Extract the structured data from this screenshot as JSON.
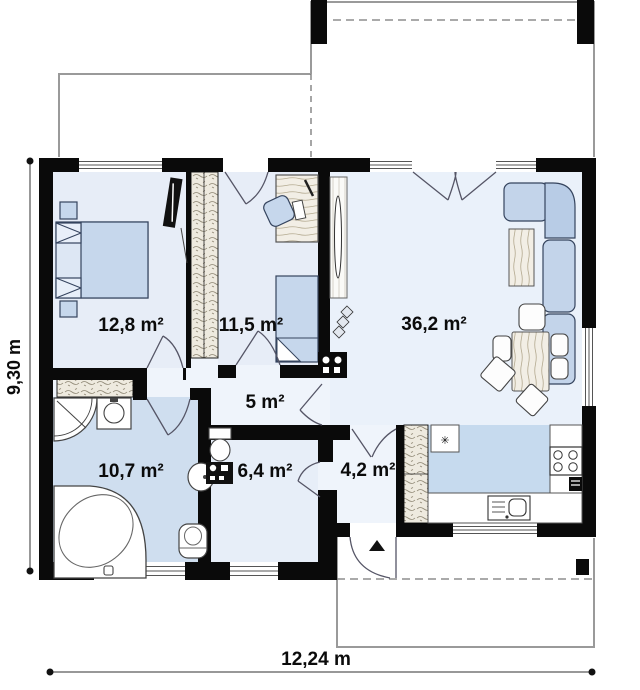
{
  "plan": {
    "rooms": [
      {
        "name": "bedroom-1",
        "area_label": "12,8 m²"
      },
      {
        "name": "bedroom-2",
        "area_label": "11,5 m²"
      },
      {
        "name": "living-room",
        "area_label": "36,2 m²"
      },
      {
        "name": "hall",
        "area_label": "5 m²"
      },
      {
        "name": "bathroom",
        "area_label": "10,7 m²"
      },
      {
        "name": "wc",
        "area_label": "6,4 m²"
      },
      {
        "name": "vestibule",
        "area_label": "4,2 m²"
      }
    ],
    "dimensions": {
      "total_width": "12,24 m",
      "total_height": "9,30 m"
    },
    "colors": {
      "wall": "#0a0a0a",
      "floor_light": "#e7edf7",
      "floor_bath": "#cfdeef",
      "floor_kitchen": "#c6daee",
      "furniture_blue": "#c6d7ec",
      "wardrobe_beige": "#eeeadf"
    }
  }
}
